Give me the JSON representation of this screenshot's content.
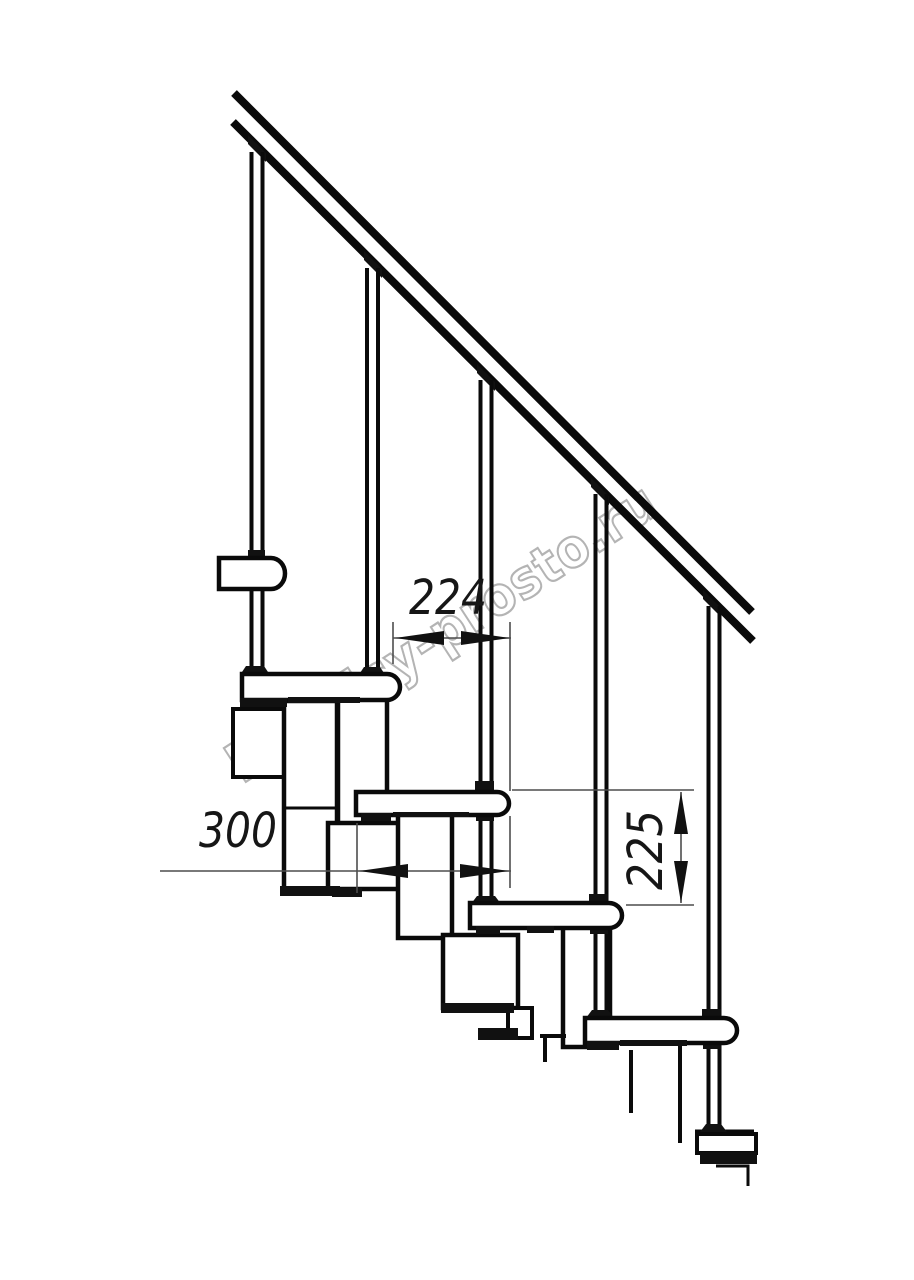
{
  "drawing": {
    "description": "Side elevation technical drawing of a modular staircase with handrail, five balusters, four treads and zigzag stringer modules",
    "colors": {
      "background": "#ffffff",
      "line": "#0a0a0a",
      "dimension_line": "#4d4d4d",
      "watermark": "#b4b4b4"
    }
  },
  "watermark": {
    "text": "lestnicy-prosto.ru",
    "color": "#b4b4b4"
  },
  "dimensions": {
    "step_run": "224",
    "tread_depth": "300",
    "step_rise": "225"
  }
}
